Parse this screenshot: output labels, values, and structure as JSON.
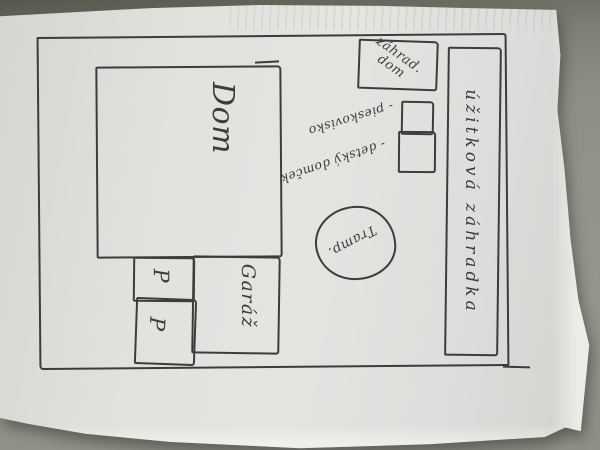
{
  "colors": {
    "ink": "#3c3c3c",
    "paper": "#e0dfdc",
    "desk": "#8f9187",
    "desk_shadow": "#5f6257"
  },
  "plan": {
    "labels": {
      "house": "Dom",
      "garage": "Garáž",
      "parking": [
        "P",
        "P"
      ],
      "garden_house_line1": "záhrad.",
      "garden_house_line2": "dom",
      "sandbox": "- pieskovisko",
      "play_house": "- detský domček",
      "trampoline": "Tramp.",
      "utility_garden": "úžitková záhradka"
    }
  }
}
